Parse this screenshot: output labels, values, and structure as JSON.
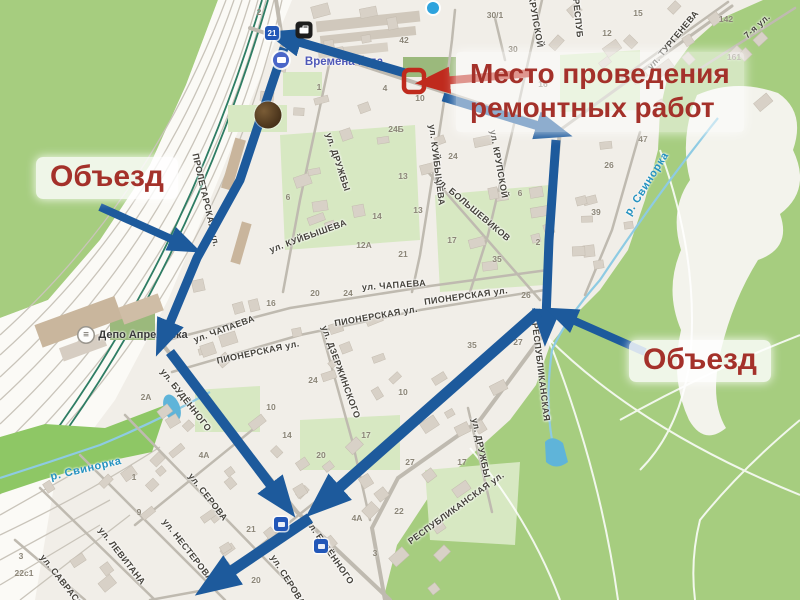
{
  "colors": {
    "route_blue": "#1d5a9c",
    "annotation_red": "#a4312a",
    "marker_red": "#bf2a1d"
  },
  "annotations": {
    "repair": {
      "line1": "Место проведения",
      "line2": "ремонтных работ"
    },
    "detour_left": "Объезд",
    "detour_right": "Объезд"
  },
  "map": {
    "pois": [
      {
        "type": "depot",
        "label": "Депо Апрелевка",
        "x": 143,
        "y": 335
      },
      {
        "type": "transit",
        "label": "Времена года",
        "x": 344,
        "y": 62
      }
    ],
    "rivers": [
      {
        "label": "р. Свинорка",
        "x": 86,
        "y": 469,
        "rot": -13
      },
      {
        "label": "р. Свинорка",
        "x": 647,
        "y": 184,
        "rot": -58
      }
    ],
    "streets": [
      {
        "label": "ул. ДРУЖБЫ",
        "x": 338,
        "y": 162,
        "rot": 72
      },
      {
        "label": "ул. КУЙБЫШЕВА",
        "x": 308,
        "y": 236,
        "rot": -20
      },
      {
        "label": "ул. КУЙБЫШЕВА",
        "x": 437,
        "y": 165,
        "rot": 83
      },
      {
        "label": "ул. БОЛЬШЕВИКОВ",
        "x": 473,
        "y": 209,
        "rot": 40
      },
      {
        "label": "КРУПСКОЙ",
        "x": 536,
        "y": 22,
        "rot": 80
      },
      {
        "label": "ул. КРУПСКОЙ",
        "x": 499,
        "y": 164,
        "rot": 80
      },
      {
        "label": "РЕСПУБ",
        "x": 578,
        "y": 18,
        "rot": 84
      },
      {
        "label": "ул. ТУРГЕНЕВА",
        "x": 673,
        "y": 40,
        "rot": -50
      },
      {
        "label": "7-я ул.",
        "x": 757,
        "y": 26,
        "rot": -42
      },
      {
        "label": "ул. ЧАПАЕВА",
        "x": 394,
        "y": 285,
        "rot": -4
      },
      {
        "label": "ул. ЧАПАЕВА",
        "x": 224,
        "y": 329,
        "rot": -20
      },
      {
        "label": "ПИОНЕРСКАЯ ул.",
        "x": 466,
        "y": 296,
        "rot": -8
      },
      {
        "label": "ПИОНЕРСКАЯ ул.",
        "x": 376,
        "y": 316,
        "rot": -10
      },
      {
        "label": "ПИОНЕРСКАЯ ул.",
        "x": 258,
        "y": 352,
        "rot": -12
      },
      {
        "label": "ул. ДЗЕРЖИНСКОГО",
        "x": 341,
        "y": 372,
        "rot": 70
      },
      {
        "label": "ул. БУДЁННОГО",
        "x": 186,
        "y": 400,
        "rot": 52
      },
      {
        "label": "ул. БУДЁННОГО",
        "x": 330,
        "y": 552,
        "rot": 55
      },
      {
        "label": "ул. СЕРОВА",
        "x": 208,
        "y": 497,
        "rot": 52
      },
      {
        "label": "ул. СЕРОВА",
        "x": 288,
        "y": 580,
        "rot": 58
      },
      {
        "label": "ул. НЕСТЕРОВА",
        "x": 188,
        "y": 550,
        "rot": 52
      },
      {
        "label": "ул. ЛЕВИТАНА",
        "x": 122,
        "y": 556,
        "rot": 52
      },
      {
        "label": "ул. САВРАСОВА",
        "x": 66,
        "y": 586,
        "rot": 52
      },
      {
        "label": "ПРОЛЕТАРСКАЯ ул.",
        "x": 206,
        "y": 200,
        "rot": 77
      },
      {
        "label": "РЕСПУБЛИКАНСКАЯ",
        "x": 541,
        "y": 372,
        "rot": 83
      },
      {
        "label": "РЕСПУБЛИКАНСКАЯ ул.",
        "x": 456,
        "y": 508,
        "rot": -36
      },
      {
        "label": "ул. ДРУЖБЫ",
        "x": 481,
        "y": 448,
        "rot": 78
      }
    ],
    "house_numbers": [
      {
        "n": "2",
        "x": 259,
        "y": 12
      },
      {
        "n": "30/1",
        "x": 495,
        "y": 15
      },
      {
        "n": "42",
        "x": 404,
        "y": 40
      },
      {
        "n": "30",
        "x": 513,
        "y": 49
      },
      {
        "n": "15",
        "x": 638,
        "y": 13
      },
      {
        "n": "12",
        "x": 607,
        "y": 33
      },
      {
        "n": "142",
        "x": 726,
        "y": 19
      },
      {
        "n": "161",
        "x": 734,
        "y": 57
      },
      {
        "n": "1",
        "x": 319,
        "y": 87
      },
      {
        "n": "4",
        "x": 385,
        "y": 88
      },
      {
        "n": "16",
        "x": 543,
        "y": 84
      },
      {
        "n": "10",
        "x": 420,
        "y": 98
      },
      {
        "n": "24Б",
        "x": 396,
        "y": 129
      },
      {
        "n": "24",
        "x": 453,
        "y": 156
      },
      {
        "n": "13",
        "x": 403,
        "y": 176
      },
      {
        "n": "13",
        "x": 418,
        "y": 210
      },
      {
        "n": "6",
        "x": 288,
        "y": 197
      },
      {
        "n": "14",
        "x": 377,
        "y": 216
      },
      {
        "n": "17",
        "x": 452,
        "y": 240
      },
      {
        "n": "12А",
        "x": 364,
        "y": 245
      },
      {
        "n": "21",
        "x": 403,
        "y": 254
      },
      {
        "n": "35",
        "x": 497,
        "y": 259
      },
      {
        "n": "2",
        "x": 538,
        "y": 242
      },
      {
        "n": "26",
        "x": 526,
        "y": 295
      },
      {
        "n": "6",
        "x": 520,
        "y": 193
      },
      {
        "n": "47",
        "x": 643,
        "y": 139
      },
      {
        "n": "26",
        "x": 609,
        "y": 165
      },
      {
        "n": "39",
        "x": 596,
        "y": 212
      },
      {
        "n": "24",
        "x": 348,
        "y": 293
      },
      {
        "n": "20",
        "x": 315,
        "y": 293
      },
      {
        "n": "16",
        "x": 271,
        "y": 303
      },
      {
        "n": "27",
        "x": 518,
        "y": 342
      },
      {
        "n": "35",
        "x": 472,
        "y": 345
      },
      {
        "n": "17",
        "x": 462,
        "y": 462
      },
      {
        "n": "27",
        "x": 410,
        "y": 462
      },
      {
        "n": "10",
        "x": 403,
        "y": 392
      },
      {
        "n": "2А",
        "x": 146,
        "y": 397
      },
      {
        "n": "10",
        "x": 271,
        "y": 407
      },
      {
        "n": "24",
        "x": 313,
        "y": 380
      },
      {
        "n": "14",
        "x": 287,
        "y": 435
      },
      {
        "n": "20",
        "x": 321,
        "y": 455
      },
      {
        "n": "4А",
        "x": 204,
        "y": 455
      },
      {
        "n": "17",
        "x": 366,
        "y": 435
      },
      {
        "n": "1",
        "x": 134,
        "y": 477
      },
      {
        "n": "9",
        "x": 139,
        "y": 512
      },
      {
        "n": "21",
        "x": 251,
        "y": 529
      },
      {
        "n": "22с1",
        "x": 24,
        "y": 573
      },
      {
        "n": "3",
        "x": 21,
        "y": 556
      },
      {
        "n": "20",
        "x": 256,
        "y": 580
      },
      {
        "n": "4А",
        "x": 357,
        "y": 518
      },
      {
        "n": "22",
        "x": 399,
        "y": 511
      },
      {
        "n": "3",
        "x": 375,
        "y": 553
      }
    ],
    "signs": [
      {
        "type": "route-badge",
        "label": "21",
        "x": 272,
        "y": 33
      },
      {
        "type": "poi-business",
        "label": "",
        "x": 304,
        "y": 30
      },
      {
        "type": "bus-stop",
        "label": "",
        "x": 281,
        "y": 60
      },
      {
        "type": "photo-marker",
        "label": "",
        "x": 268,
        "y": 115
      },
      {
        "type": "depot-icon",
        "label": "",
        "x": 86,
        "y": 335
      },
      {
        "type": "route-badge",
        "label": "",
        "x": 281,
        "y": 524
      },
      {
        "type": "route-badge",
        "label": "",
        "x": 321,
        "y": 546
      },
      {
        "type": "map-dot",
        "label": "",
        "x": 433,
        "y": 8
      }
    ]
  }
}
